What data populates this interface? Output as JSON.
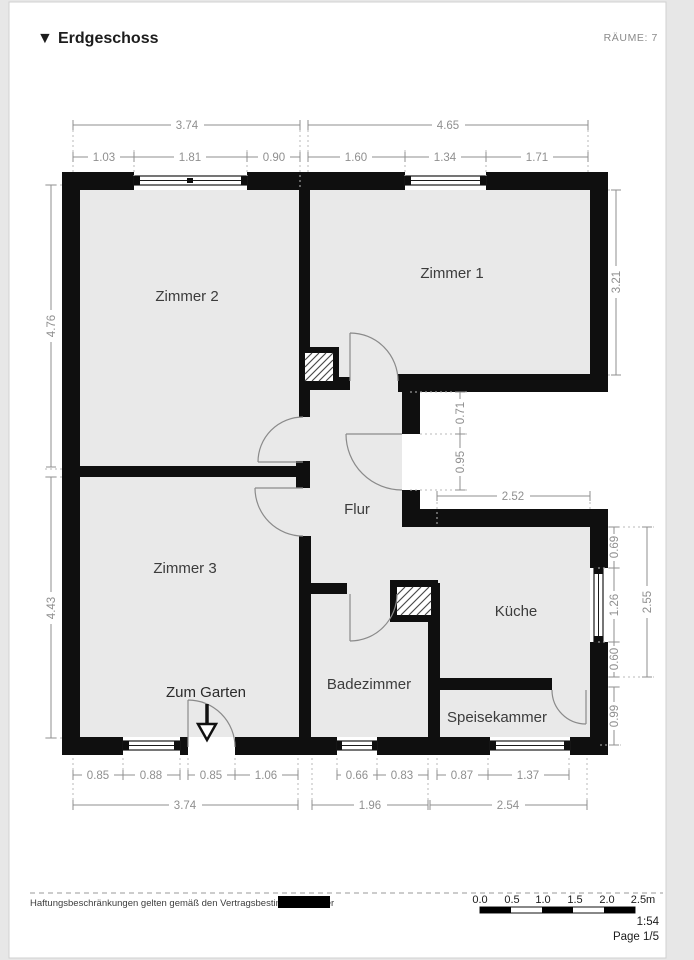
{
  "header": {
    "collapse_icon": "▼",
    "title": "Erdgeschoss",
    "rooms_count_label": "RÄUME: 7"
  },
  "floorplan": {
    "room_labels": {
      "zimmer1": "Zimmer 1",
      "zimmer2": "Zimmer 2",
      "zimmer3": "Zimmer 3",
      "flur": "Flur",
      "kueche": "Küche",
      "badezimmer": "Badezimmer",
      "speisekammer": "Speisekammer",
      "garden_exit": "Zum Garten"
    },
    "dimensions": {
      "top_totals": [
        "3.74",
        "4.65"
      ],
      "top_segments": [
        "1.03",
        "1.81",
        "0.90",
        "1.60",
        "1.34",
        "1.71"
      ],
      "left_side": [
        "4.76",
        "4.43"
      ],
      "right_zimmer1": "3.21",
      "recess": [
        "0.71",
        "0.95",
        "2.52"
      ],
      "kitchen_right": [
        "0.69",
        "1.26",
        "0.60",
        "2.55",
        "0.99"
      ],
      "bottom_segments": [
        "0.85",
        "0.88",
        "0.85",
        "1.06",
        "0.66",
        "0.83",
        "0.87",
        "1.37"
      ],
      "bottom_totals": [
        "3.74",
        "1.96",
        "2.54"
      ]
    }
  },
  "footer": {
    "disclaimer": "Haftungsbeschränkungen gelten gemäß den Vertragsbestimmungen der",
    "scale_bar_labels": [
      "0.0",
      "0.5",
      "1.0",
      "1.5",
      "2.0",
      "2.5m"
    ],
    "scale_ratio": "1:54",
    "page_indicator": "Page 1/5"
  },
  "colors": {
    "wall": "#0f0f0f",
    "floor": "#e9e9e9",
    "dimension": "#8f8f8f",
    "page": "#ffffff"
  }
}
